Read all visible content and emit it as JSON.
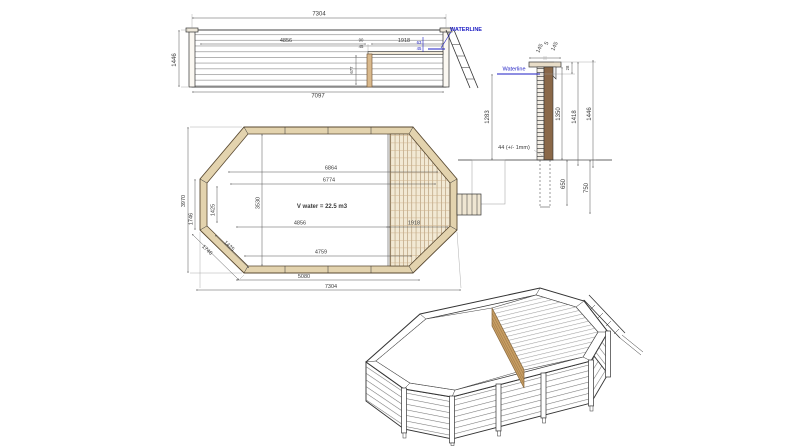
{
  "colors": {
    "line": "#333333",
    "dim_text": "#3a3a3a",
    "waterline_blue": "#1d1dc4",
    "wood_light": "#e3d3ae",
    "wood_mid": "#d9b98c",
    "wood_dark": "#8a6848"
  },
  "elevation": {
    "waterline_label": "WATERLINE",
    "dims": {
      "overall_top": "7304",
      "height": "1446",
      "overall_bottom": "7097",
      "swim_length": "4856",
      "deck_length": "1918",
      "rim_small_a": "90",
      "rim_small_b": "45",
      "wl_small_a": "63",
      "wl_small_b": "45",
      "post_height": "677"
    }
  },
  "section": {
    "waterline_label": "Waterline",
    "dims": {
      "cap_left": "145",
      "cap_gap": "5",
      "cap_right": "145",
      "rim_to_waterline": "28",
      "wall_planks": "1350",
      "wall_with_cap": "1418",
      "total_height": "1446",
      "water_depth": "1283",
      "plank_tolerance": "44 (+/- 1mm)",
      "below_ground_a": "650",
      "below_ground_b": "750"
    }
  },
  "plan": {
    "volume_label": "V water = 22.5 m3",
    "dims": {
      "inner_length_a": "6864",
      "inner_length_b": "6774",
      "swim_length": "4856",
      "deck_length": "1918",
      "straight_top": "4759",
      "straight_bottom": "5080",
      "overall_length": "7304",
      "overall_width": "3970",
      "side_outer": "1746",
      "side_inner": "1425",
      "diagonal_inner": "1425",
      "diagonal_outer": "1746",
      "inner_width": "3530"
    }
  }
}
